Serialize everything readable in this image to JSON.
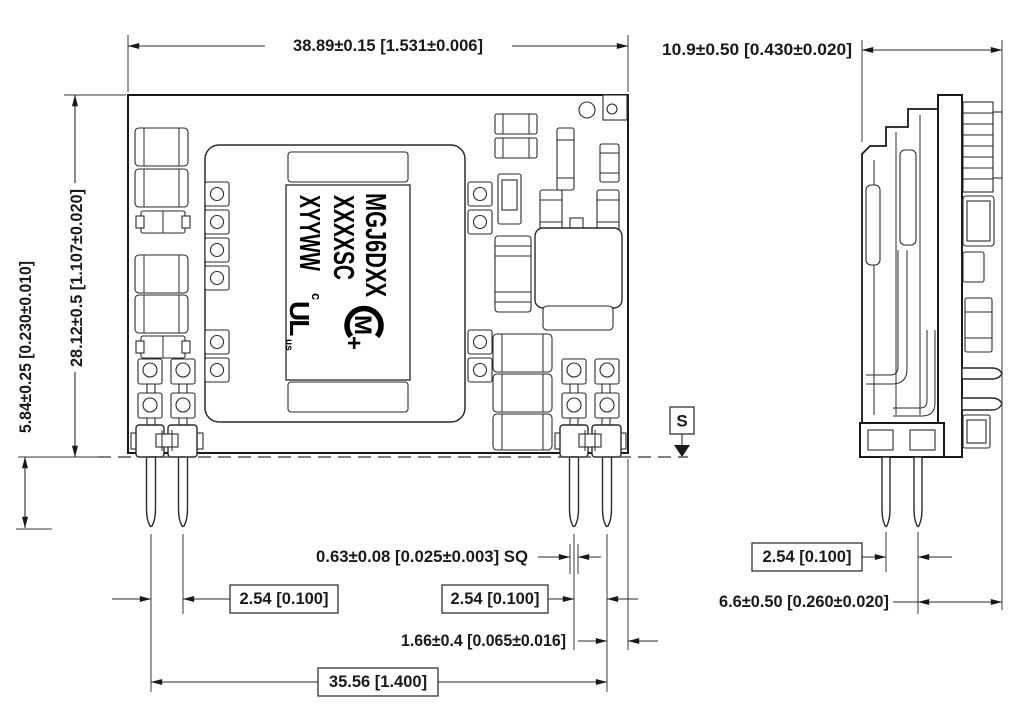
{
  "dimensions": {
    "top_width": "38.89±0.15 [1.531±0.006]",
    "side_width": "10.9±0.50 [0.430±0.020]",
    "body_height": "28.12±0.5 [1.107±0.020]",
    "standoff_height": "5.84±0.25 [0.230±0.010]",
    "pin_square": "0.63±0.08 [0.025±0.003] SQ",
    "pin_pitch_left": "2.54 [0.100]",
    "pin_pitch_right": "2.54 [0.100]",
    "pin_to_edge": "1.66±0.4 [0.065±0.016]",
    "pin_span": "35.56 [1.400]",
    "side_pin_pitch": "2.54 [0.100]",
    "side_pin_to_edge": "6.6±0.50 [0.260±0.020]"
  },
  "datum": {
    "label": "S"
  },
  "module_label": {
    "line1": "MGJ6DXX",
    "line2": "XXXXSC",
    "line3": "XYYWW",
    "logo_letter": "M",
    "logo_plus": "+",
    "ul_prefix": "c",
    "ul_main": "UL",
    "ul_suffix": "us"
  },
  "colors": {
    "line": "#1a1a1a",
    "background": "#ffffff"
  }
}
